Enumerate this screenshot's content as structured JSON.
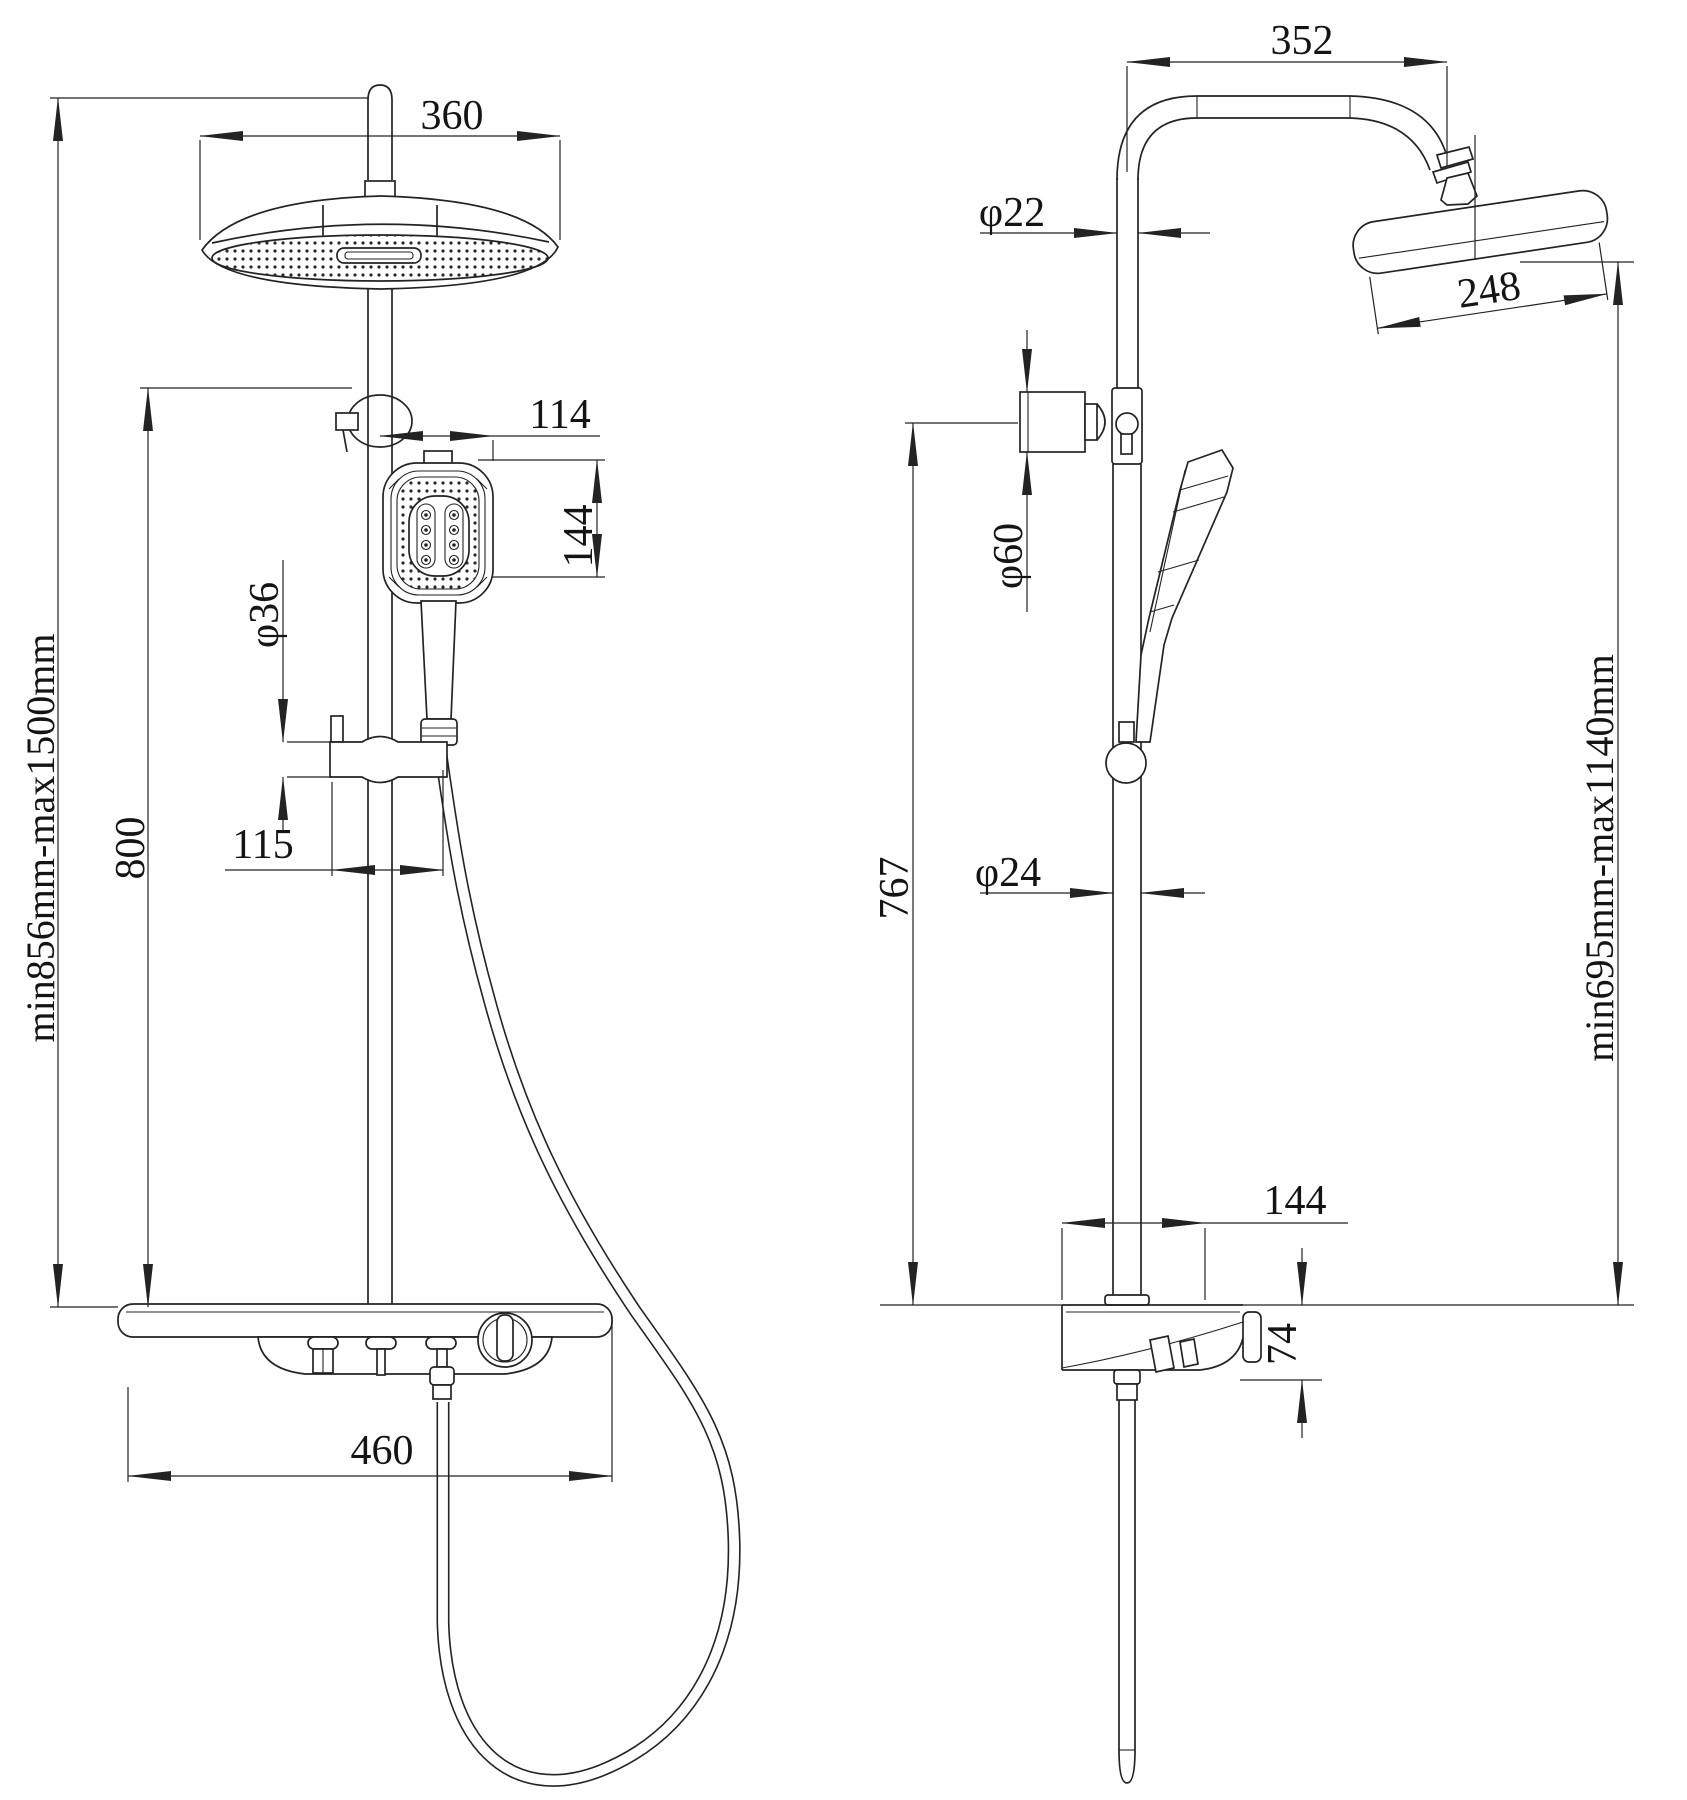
{
  "dims": {
    "front": {
      "head_width": "360",
      "hand_shower_width": "114",
      "hand_shower_height": "144",
      "slider_diameter": "φ36",
      "slider_offset": "115",
      "slide_bar_height": "800",
      "overall_height_range": "min856mm-max1500mm",
      "shelf_width": "460"
    },
    "side": {
      "arm_reach": "352",
      "riser_pipe_diameter": "φ22",
      "head_diameter": "248",
      "wall_mount_diameter": "φ60",
      "mount_to_shelf_height": "767",
      "pole_diameter": "φ24",
      "shelf_depth": "144",
      "shelf_thickness": "74",
      "head_height_range": "min695mm-max1140mm"
    }
  }
}
